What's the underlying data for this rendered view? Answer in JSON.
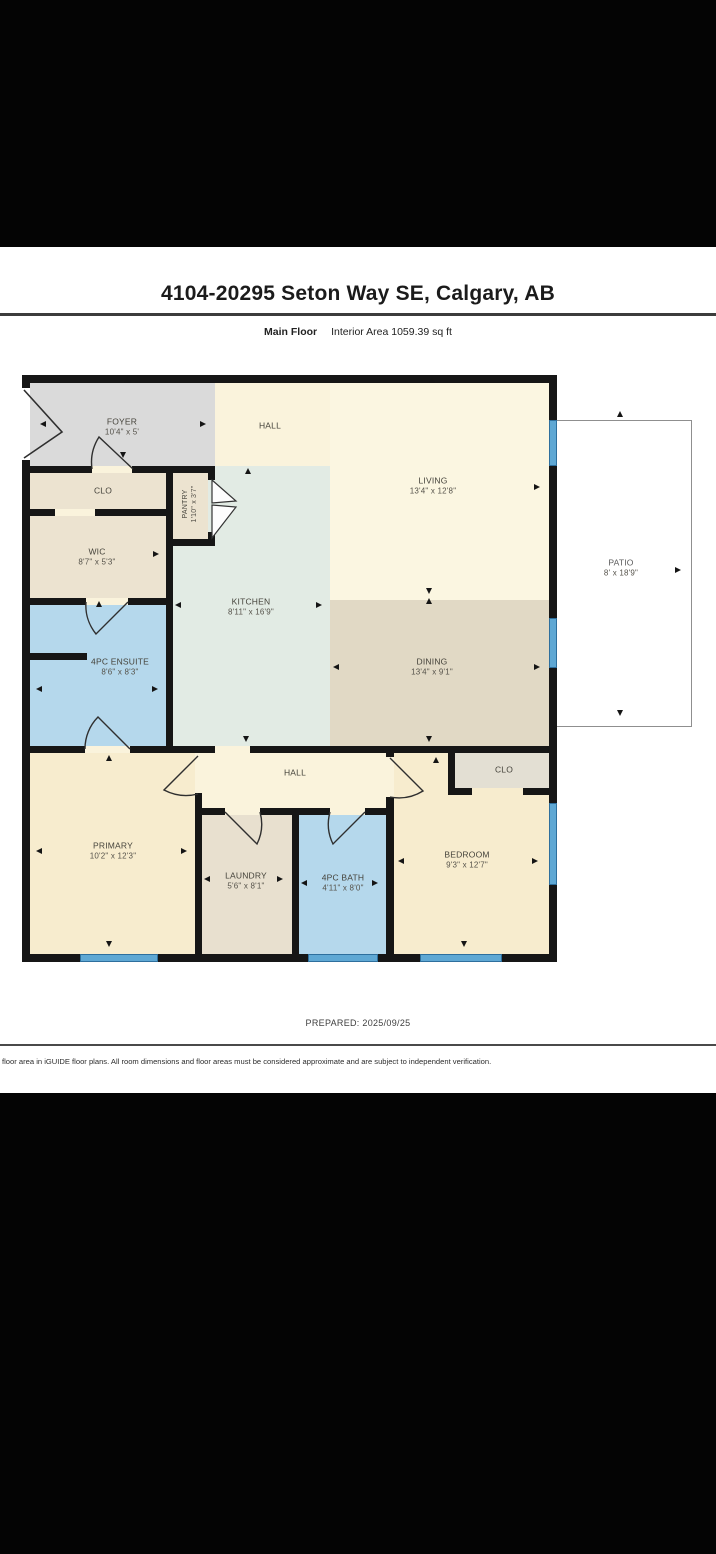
{
  "header": {
    "title": "4104-20295 Seton Way SE, Calgary, AB",
    "floor_label": "Main Floor",
    "area_label": "Interior Area 1059.39 sq ft"
  },
  "footer": {
    "prepared": "PREPARED: 2025/09/25",
    "disclaimer": "floor area in iGUIDE floor plans. All room dimensions and floor areas must be considered approximate and are subject to independent verification."
  },
  "rooms": [
    {
      "name": "FOYER",
      "dims": "10'4\" x 5'"
    },
    {
      "name": "HALL",
      "dims": ""
    },
    {
      "name": "LIVING",
      "dims": "13'4\" x 12'8\""
    },
    {
      "name": "PATIO",
      "dims": "8' x 18'9\""
    },
    {
      "name": "CLO",
      "dims": ""
    },
    {
      "name": "PANTRY",
      "dims": "1'10\" x 3'7\""
    },
    {
      "name": "WIC",
      "dims": "8'7\" x 5'3\""
    },
    {
      "name": "KITCHEN",
      "dims": "8'11\" x 16'9\""
    },
    {
      "name": "DINING",
      "dims": "13'4\" x 9'1\""
    },
    {
      "name": "4PC ENSUITE",
      "dims": "8'6\" x 8'3\""
    },
    {
      "name": "PRIMARY",
      "dims": "10'2\" x 12'3\""
    },
    {
      "name": "HALL",
      "dims": ""
    },
    {
      "name": "LAUNDRY",
      "dims": "5'6\" x 8'1\""
    },
    {
      "name": "4PC BATH",
      "dims": "4'11\" x 8'0\""
    },
    {
      "name": "BEDROOM",
      "dims": "9'3\" x 12'7\""
    },
    {
      "name": "CLO",
      "dims": ""
    }
  ],
  "colors": {
    "wall": "#161616",
    "hall_living_cream": "#faf3dc",
    "living_light": "#fbf6e1",
    "foyer_gray": "#dadada",
    "closet_beige": "#ece3d0",
    "kitchen_mint": "#e2ebe4",
    "dining_tan": "#e1d9c5",
    "bath_blue": "#b5d8ec",
    "bedroom_cream": "#f7ecce",
    "closet_gray": "#e3dfd3",
    "window_blue": "#5fa8d4"
  },
  "icons": {
    "dimension_arrow": "small black triangle marker",
    "door_swing": "quarter-arc door leaf"
  }
}
